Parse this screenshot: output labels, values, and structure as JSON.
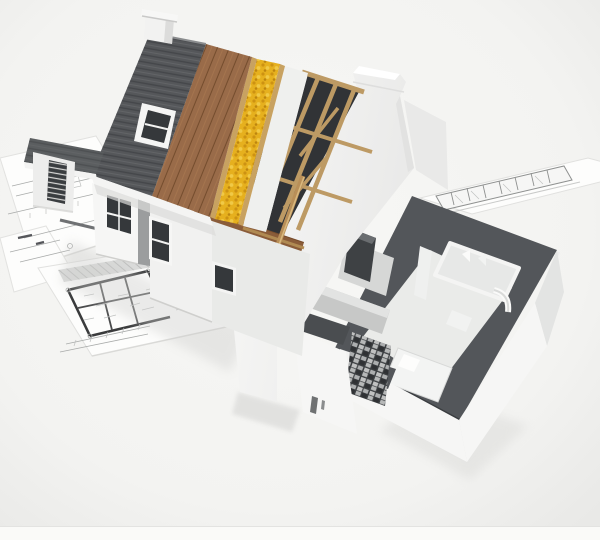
{
  "scene": {
    "description": "3D architectural rendering of a house under construction, cut away to show dark roof tiles, timber sheathing, yellow insulation, exposed wooden rafters and a furnished ground-floor cutaway, standing on architectural blueprint floor plans",
    "type": "architectural-visualization"
  },
  "colors": {
    "background": "#f3f3f1",
    "bottom_strip": "#fafaf8",
    "paper": "#fdfdfc",
    "roof_tile": "#55575a",
    "sheathing_wood": "#996b49",
    "insulation": "#e6b01e",
    "batten_wood": "#c8a261",
    "roof_deck": "#eff0ee",
    "rafter_wood": "#bd9a64",
    "attic_floor": "#8a5c39",
    "attic_shadow": "#313336",
    "wall_white": "#f6f6f5",
    "wall_dark_cap": "#53565a",
    "wall_dark_cap_shade": "#4a4d50",
    "floor_interior": "#eaebe9",
    "unit_dark": "#3e4144",
    "pillar_dark": "#3b3e41",
    "window_glass": "#35383b"
  }
}
